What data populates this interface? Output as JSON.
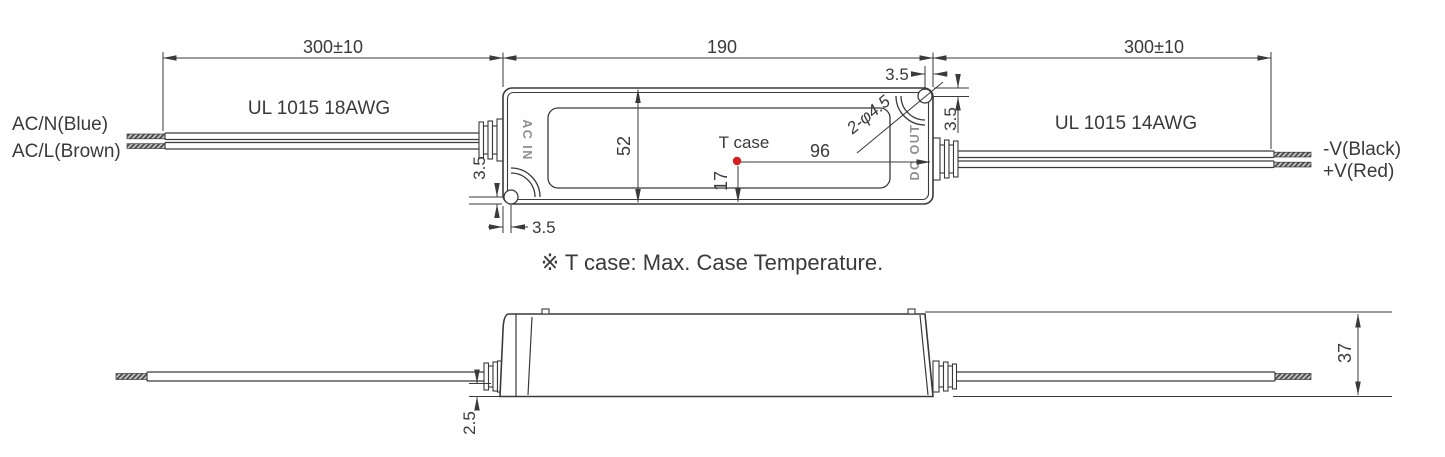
{
  "colors": {
    "line": "#3a3a3a",
    "port_text": "#8f8f8f",
    "tcase_dot": "#d42020",
    "background": "#ffffff"
  },
  "top_view": {
    "dim_left_wire_length": "300±10",
    "dim_body_length": "190",
    "dim_right_wire_length": "300±10",
    "left_wire_label_top": "AC/N(Blue)",
    "left_wire_label_bottom": "AC/L(Brown)",
    "left_wire_spec": "UL 1015 18AWG",
    "right_wire_spec": "UL 1015 14AWG",
    "right_wire_label_top": "-V(Black)",
    "right_wire_label_bottom": "+V(Red)",
    "port_input": "AC IN",
    "port_output": "DC OUT",
    "dim_body_width": "52",
    "tcase_label": "T case",
    "dim_tcase_from_point": "96",
    "dim_tcase_from_bottom": "17",
    "mounting_hole_spec": "2-φ4.5",
    "dim_hole_top_right_h": "3.5",
    "dim_hole_top_right_v": "3.5",
    "dim_hole_bottom_left_v": "3.5",
    "dim_hole_bottom_left_h": "3.5"
  },
  "note": "※ T case: Max. Case Temperature.",
  "side_view": {
    "dim_height": "37",
    "dim_wire_offset": "2.5"
  }
}
